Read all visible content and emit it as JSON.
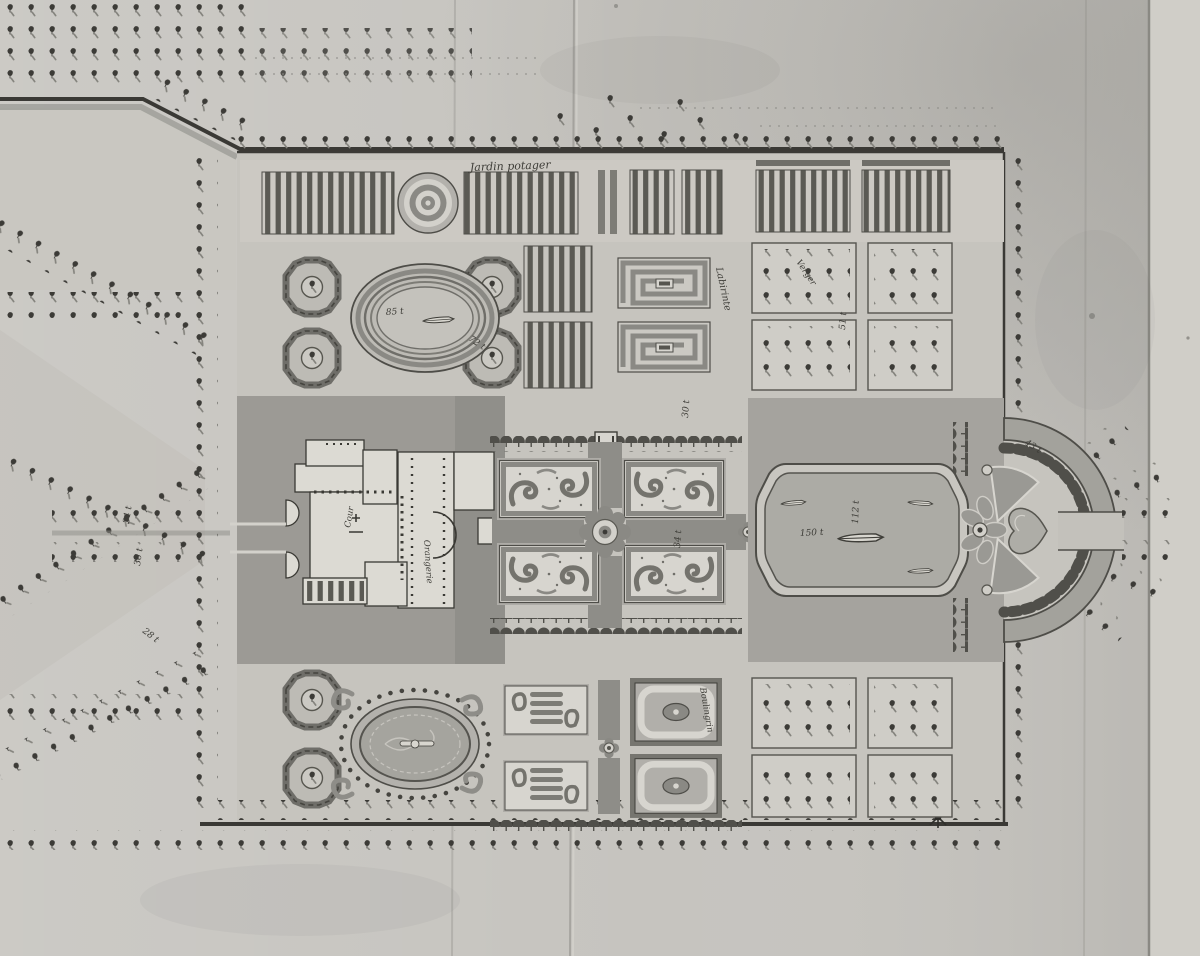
{
  "plan": {
    "labels": {
      "kitchen_garden": "Jardin potager",
      "labyrinth": "Labirinte",
      "courtyard": "Cour",
      "orangery": "Orangerie",
      "bowling_green": "Boulingrin",
      "orchard": "Verger"
    },
    "measurements": {
      "arena_width": "85 t",
      "arena_ramp": "72 t",
      "basin_length": "150 t",
      "basin_width": "112 t",
      "parterre_alley": "34 t",
      "terrace_walk": "30 t",
      "bosquet_side": "51 t",
      "exedra_walk": "43 t",
      "west_avenue_a": "34 t",
      "west_avenue_b": "36 t",
      "west_diagonal": "28 t"
    },
    "palette": {
      "paper": "#c6c4bf",
      "paper_light": "#d2d0ca",
      "ink": "#2f2e2b",
      "wash_dark": "#8e8d88",
      "wash_ground": "#9c9a95",
      "water": "#acaba5",
      "building": "#dcdad3",
      "tree": "#3c3b37"
    }
  }
}
